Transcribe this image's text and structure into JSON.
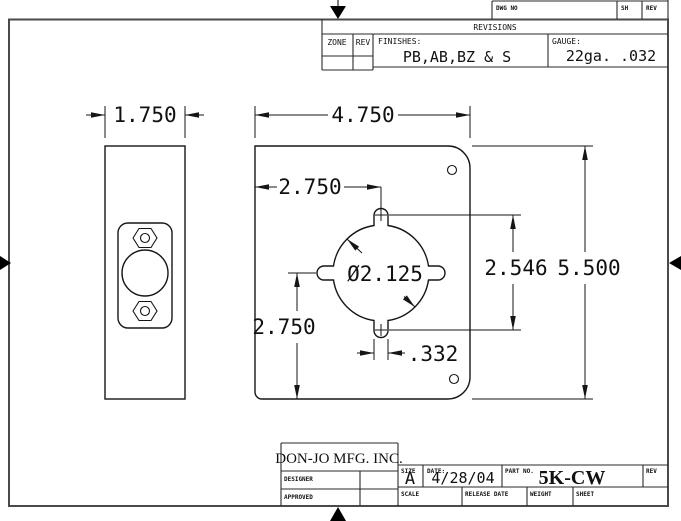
{
  "colors": {
    "line": "#161616",
    "frame": "#4a4a4a",
    "background": "#ffffff"
  },
  "border_strip": {
    "dwg_no_label": "DWG NO",
    "sh_label": "SH",
    "rev_label": "REV"
  },
  "revisions": {
    "title": "REVISIONS",
    "zone_label": "ZONE",
    "rev_label": "REV",
    "finishes_label": "FINISHES:",
    "finishes_value": "PB,AB,BZ & S",
    "gauge_label": "GAUGE:",
    "gauge_value": "22ga.  .032"
  },
  "title_block": {
    "company": "DON-JO MFG. INC.",
    "designer_label": "DESIGNER",
    "approved_label": "APPROVED",
    "size_label": "SIZE",
    "size_value": "A",
    "date_label": "DATE:",
    "date_value": "4/28/04",
    "part_no_label": "PART NO.",
    "part_no_value": "5K-CW",
    "rev_label": "REV",
    "scale_label": "SCALE",
    "release_date_label": "RELEASE DATE",
    "weight_label": "WEIGHT",
    "sheet_label": "SHEET"
  },
  "dimensions": {
    "front_width": "1.750",
    "plate_width": "4.750",
    "bore_offset_left": "2.750",
    "bore_diameter": "Ø2.125",
    "lug_span": "2.546",
    "plate_height": "5.500",
    "bore_offset_bottom": "2.750",
    "lug_width": ".332"
  }
}
